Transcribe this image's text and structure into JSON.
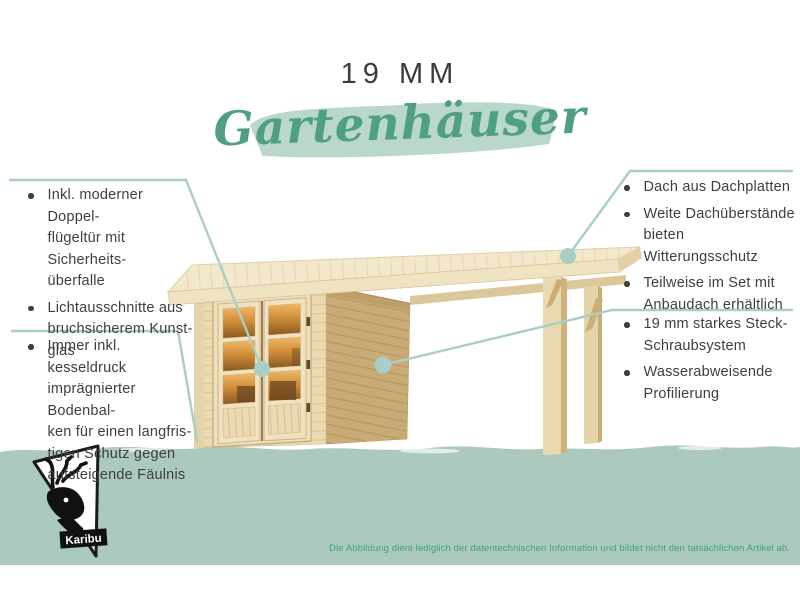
{
  "header": {
    "title": "19 MM",
    "subtitle": "Gartenhäuser"
  },
  "callouts": {
    "left_top": {
      "bullets": [
        {
          "lines": [
            "Inkl. moderner Doppel-",
            "flügeltür mit Sicherheits-",
            "überfalle"
          ]
        },
        {
          "lines": [
            "Lichtausschnitte aus",
            "bruchsicherem Kunst-",
            "glas"
          ]
        }
      ]
    },
    "left_bottom": {
      "bullets": [
        {
          "lines": [
            "Immer inkl. kesseldruck",
            "imprägnierter Bodenbal-",
            "ken für einen langfris-",
            "tigen Schutz gegen",
            "aufsteigende Fäulnis"
          ]
        }
      ]
    },
    "right_top": {
      "bullets": [
        {
          "lines": [
            "Dach aus Dachplatten"
          ]
        },
        {
          "lines": [
            "Weite Dachüberstände",
            "bieten Witterungsschutz"
          ]
        },
        {
          "lines": [
            "Teilweise im Set mit",
            "Anbaudach erhältlich"
          ]
        }
      ]
    },
    "right_bottom": {
      "bullets": [
        {
          "lines": [
            "19 mm starkes Steck-",
            "Schraubsystem"
          ]
        },
        {
          "lines": [
            "Wasserabweisende",
            "Profilierung"
          ]
        }
      ]
    }
  },
  "footer": {
    "logo": {
      "icon": "deer-icon",
      "label": "Karibu"
    },
    "disclaimer": "Die Abbildung dient lediglich der datentechnischen Information und bildet nicht den tatsächlichen Artikel ab."
  },
  "colors": {
    "accent_green": "#4f9f82",
    "brush_green": "#b9d8c9",
    "band_green": "#abc9bc",
    "callout_line": "#a9cfc4",
    "body_text": "#3e3e40",
    "disclaimer_green": "#3da47b",
    "wood_light": "#ebd9b1",
    "wood_dark": "#c9ab77"
  }
}
